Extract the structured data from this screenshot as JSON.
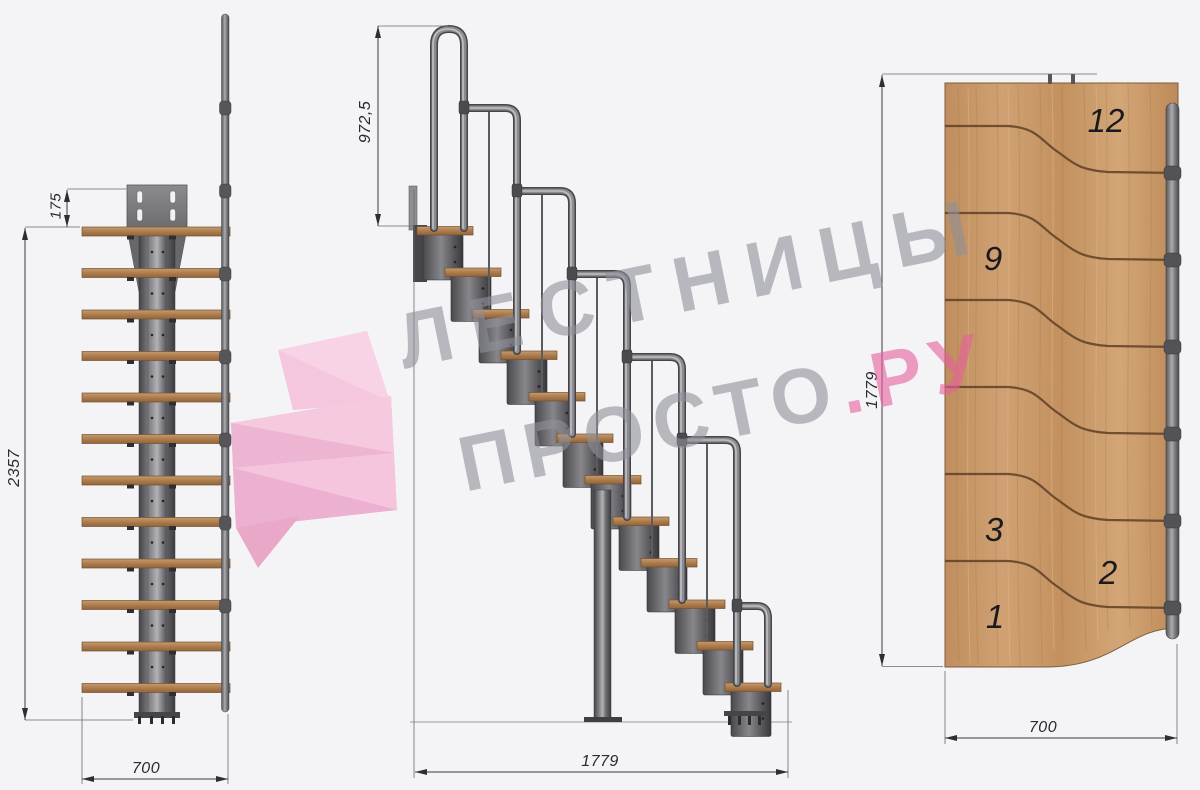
{
  "watermark": {
    "line1": "ЛЕСТНИЦЫ",
    "line2_gray": "ПРОСТО",
    "line2_pink": ".РУ",
    "gray_color": "#90909a",
    "pink_color": "#e75f9d"
  },
  "views": {
    "front": {
      "dim_offset": "175",
      "dim_height": "2357",
      "dim_width": "700"
    },
    "side": {
      "dim_rail_height": "972,5",
      "dim_length": "1779"
    },
    "plan": {
      "dim_length": "1779",
      "dim_width": "700",
      "step_numbers": [
        "12",
        "9",
        "3",
        "2",
        "1"
      ]
    }
  },
  "colors": {
    "background": "#f4f4f6",
    "wood": "#c0905f",
    "wood_groove": "#5e3f26",
    "metal": "#6d6d72",
    "dimension_text": "#2a2a2e"
  }
}
